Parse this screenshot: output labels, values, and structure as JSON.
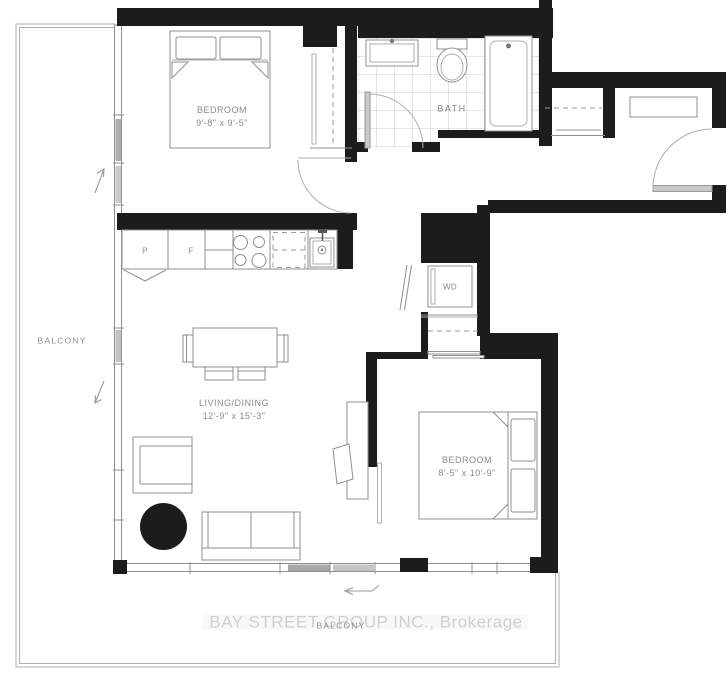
{
  "plan": {
    "rooms": {
      "bedroom1": {
        "name": "BEDROOM",
        "dims": "9'-8\" x 9'-5\""
      },
      "bath": {
        "name": "BATH"
      },
      "living": {
        "name": "LIVING/DINING",
        "dims": "12'-9\" x 15'-3\""
      },
      "bedroom2": {
        "name": "BEDROOM",
        "dims": "8'-5\" x 10'-9\""
      },
      "balcony_left": {
        "name": "BALCONY"
      },
      "balcony_bottom": {
        "name": "BALCONY"
      }
    },
    "appliances": {
      "pantry": "P",
      "fridge": "F",
      "washer_dryer": "WD"
    },
    "watermark": "BAY STREET GROUP INC., Brokerage",
    "colors": {
      "wall": "#1c1c1c",
      "line": "#8f8f8f",
      "light_line": "#aeaeae",
      "tile_line": "#cccccc",
      "label": "#8a8a8a",
      "watermark": "#d0d0d0",
      "door_panel": "#c9c9c9"
    }
  }
}
